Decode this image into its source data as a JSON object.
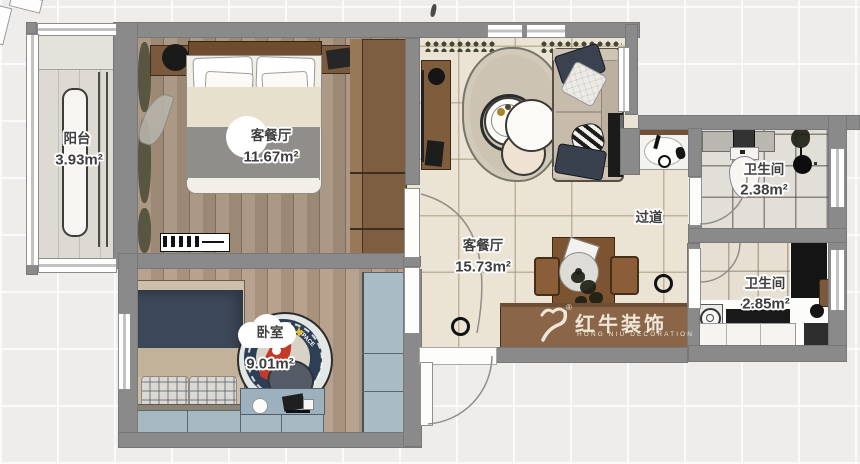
{
  "rooms": {
    "balcony": {
      "name": "阳台",
      "area": "3.93m²"
    },
    "bedroom_master": {
      "name": "客餐厅",
      "area": "11.67m²"
    },
    "living_dining": {
      "name": "客餐厅",
      "area": "15.73m²"
    },
    "hallway": {
      "name": "过道"
    },
    "bath_top": {
      "name": "卫生间",
      "area": "2.38m²"
    },
    "bath_bottom": {
      "name": "卫生间",
      "area": "2.85m²"
    },
    "bedroom_second": {
      "name": "卧室",
      "area": "9.01m²"
    }
  },
  "watermark": {
    "brand": "红牛装饰",
    "subtitle": "HONG NIU DECORATION",
    "registered": "®"
  },
  "decor": {
    "rug_text": "SPACE"
  },
  "colors": {
    "wall": "#8a8a8a",
    "wood_floor": "#a5907c",
    "tile_floor": "#ebe3d3",
    "cabinet_brown": "#8a6547",
    "navy": "#3c4859",
    "blue_gray": "#a6b8c2",
    "watermark_cream": "#f0e9d8"
  }
}
